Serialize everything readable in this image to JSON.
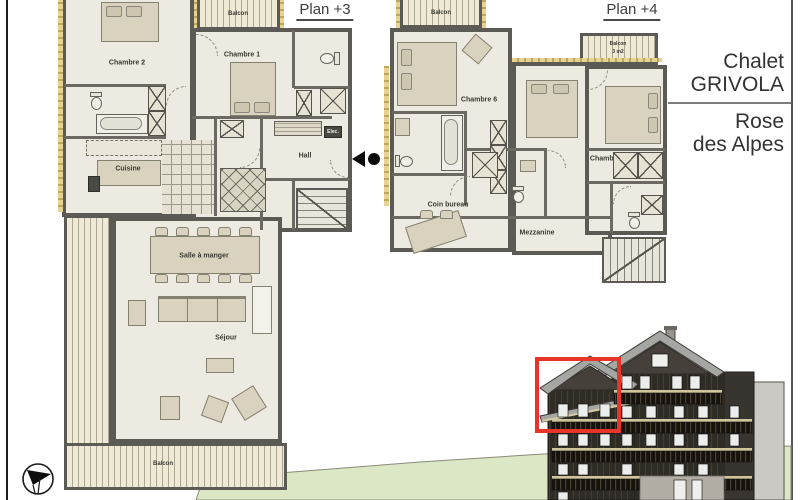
{
  "titles": {
    "plan_left": "Plan +3",
    "plan_right": "Plan +4"
  },
  "sidebar": {
    "chalet_line1": "Chalet",
    "chalet_line2": "GRIVOLA",
    "residence_line1": "Rose",
    "residence_line2": "des Alpes"
  },
  "plan3": {
    "balcon_top": "Balcon",
    "chambre_2": "Chambre 2",
    "chambre_1": "Chambre 1",
    "cuisine": "Cuisine",
    "hall": "Hall",
    "elec": "Elec.",
    "salle_a_manger": "Salle à manger",
    "sejour": "Séjour",
    "balcon_bottom": "Balcon"
  },
  "plan4": {
    "balcon_top": "Balcon",
    "balcon_small_line1": "Balcon",
    "balcon_small_line2": "3 m2",
    "chambre_6": "Chambre 6",
    "chambre_3": "Chambre 3",
    "coin_bureau": "Coin bureau",
    "mezzanine": "Mezzanine"
  },
  "colors": {
    "wall": "#5c5a55",
    "room_fill": "#edebe1",
    "furniture": "#d9d2bf",
    "accent_yellow": "#e0c97e",
    "grass": "#dbe7c5",
    "highlight_red": "#e8352a",
    "title_text": "#3f3f3f"
  }
}
